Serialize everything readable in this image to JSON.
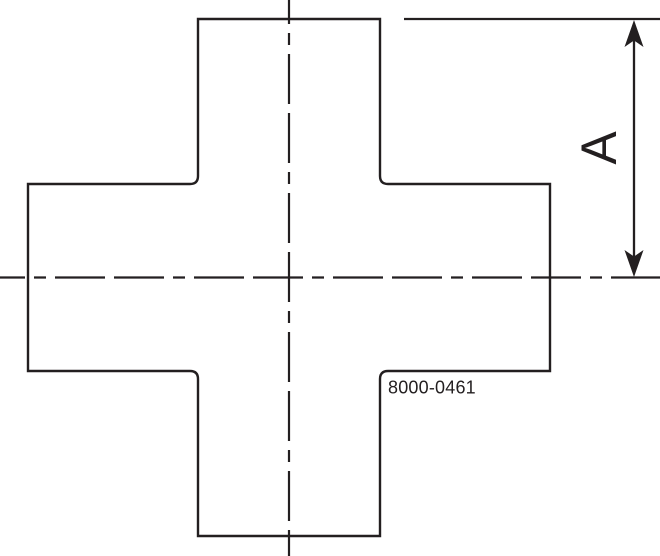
{
  "drawing": {
    "dimension_label": "A",
    "part_number": "8000-0461"
  },
  "colors": {
    "line": "#231f20",
    "background": "#ffffff"
  }
}
